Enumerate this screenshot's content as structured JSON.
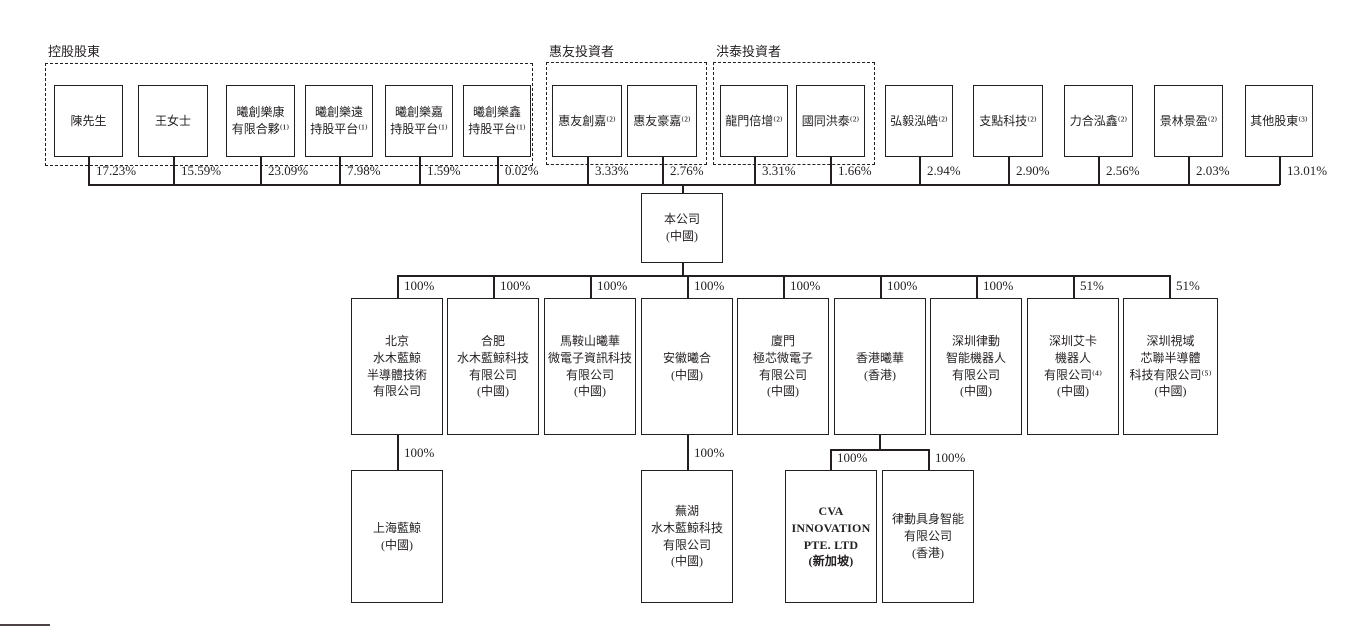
{
  "diagram": {
    "groups": [
      {
        "label": "控股股東"
      },
      {
        "label": "惠友投資者"
      },
      {
        "label": "洪泰投資者"
      }
    ],
    "shareholders": [
      {
        "name": "陳先生",
        "pct": "17.23%"
      },
      {
        "name": "王女士",
        "pct": "15.59%"
      },
      {
        "name": "曦創樂康\n有限合夥⁽¹⁾",
        "pct": "23.09%"
      },
      {
        "name": "曦創樂遠\n持股平台⁽¹⁾",
        "pct": "7.98%"
      },
      {
        "name": "曦創樂嘉\n持股平台⁽¹⁾",
        "pct": "1.59%"
      },
      {
        "name": "曦創樂鑫\n持股平台⁽¹⁾",
        "pct": "0.02%"
      },
      {
        "name": "惠友創嘉⁽²⁾",
        "pct": "3.33%"
      },
      {
        "name": "惠友豪嘉⁽²⁾",
        "pct": "2.76%"
      },
      {
        "name": "龍門倍增⁽²⁾",
        "pct": "3.31%"
      },
      {
        "name": "國同洪泰⁽²⁾",
        "pct": "1.66%"
      },
      {
        "name": "弘毅泓皓⁽²⁾",
        "pct": "2.94%"
      },
      {
        "name": "支點科技⁽²⁾",
        "pct": "2.90%"
      },
      {
        "name": "力合泓鑫⁽²⁾",
        "pct": "2.56%"
      },
      {
        "name": "景林景盈⁽²⁾",
        "pct": "2.03%"
      },
      {
        "name": "其他股東⁽³⁾",
        "pct": "13.01%"
      }
    ],
    "company": {
      "name": "本公司\n(中國)"
    },
    "subsidiaries": [
      {
        "name": "北京\n水木藍鯨\n半導體技術\n有限公司",
        "pct": "100%"
      },
      {
        "name": "合肥\n水木藍鯨科技\n有限公司\n(中國)",
        "pct": "100%"
      },
      {
        "name": "馬鞍山曦華\n微電子資訊科技\n有限公司\n(中國)",
        "pct": "100%"
      },
      {
        "name": "安徽曦合\n(中國)",
        "pct": "100%"
      },
      {
        "name": "廈門\n極芯微電子\n有限公司\n(中國)",
        "pct": "100%"
      },
      {
        "name": "香港曦華\n(香港)",
        "pct": "100%"
      },
      {
        "name": "深圳律動\n智能機器人\n有限公司\n(中國)",
        "pct": "100%"
      },
      {
        "name": "深圳艾卡\n機器人\n有限公司⁽⁴⁾\n(中國)",
        "pct": "51%"
      },
      {
        "name": "深圳視域\n芯聯半導體\n科技有限公司⁽⁵⁾\n(中國)",
        "pct": "51%"
      }
    ],
    "sub_subsidiaries": [
      {
        "name": "上海藍鯨\n(中國)",
        "pct": "100%"
      },
      {
        "name": "蕪湖\n水木藍鯨科技\n有限公司\n(中國)",
        "pct": "100%"
      },
      {
        "name": "CVA\nINNOVATION\nPTE. LTD\n(新加坡)",
        "pct": "100%"
      },
      {
        "name": "律動具身智能\n有限公司\n(香港)",
        "pct": "100%"
      }
    ]
  }
}
